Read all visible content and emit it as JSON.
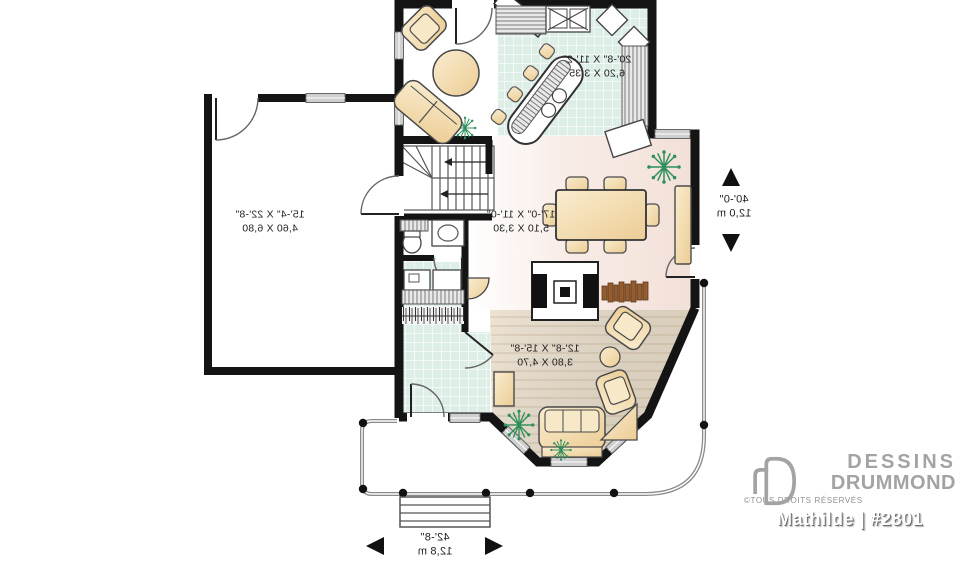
{
  "page": {
    "background": "#ffffff"
  },
  "brand": {
    "line1": "DESSINS",
    "line2": "DRUMMOND",
    "rights": "©TOUS DROITS RÉSERVÉS",
    "model_line": "Mathilde  | #2801"
  },
  "rooms": {
    "kitchen": {
      "imperial": "20'-8\" X 11'-2\"",
      "metric": "6,20 X 3,35"
    },
    "dining": {
      "imperial": "17'-0\" X 11'-0\"",
      "metric": "5,10 X 3,30"
    },
    "garage": {
      "imperial": "15'-4\" X 22'-8\"",
      "metric": "4,60 X 6,80"
    },
    "living": {
      "imperial": "12'-8\" X 15'-8\"",
      "metric": "3,80 X 4,70"
    }
  },
  "overall_dimensions": {
    "depth": {
      "imperial": "40'-0\"",
      "metric": "12,0 m"
    },
    "width": {
      "imperial": "42'-8\"",
      "metric": "12,8 m"
    }
  },
  "colors": {
    "wall": "#141414",
    "kitchen_tile": "#ddeee6",
    "dining_floor": "#f6e8e2",
    "living_floor": "#e9dfd0",
    "furniture": "#f2d9a8",
    "plant": "#2f8f5b",
    "window_grey": "#cfcfcf",
    "logo_grey": "#a3a3a3"
  }
}
